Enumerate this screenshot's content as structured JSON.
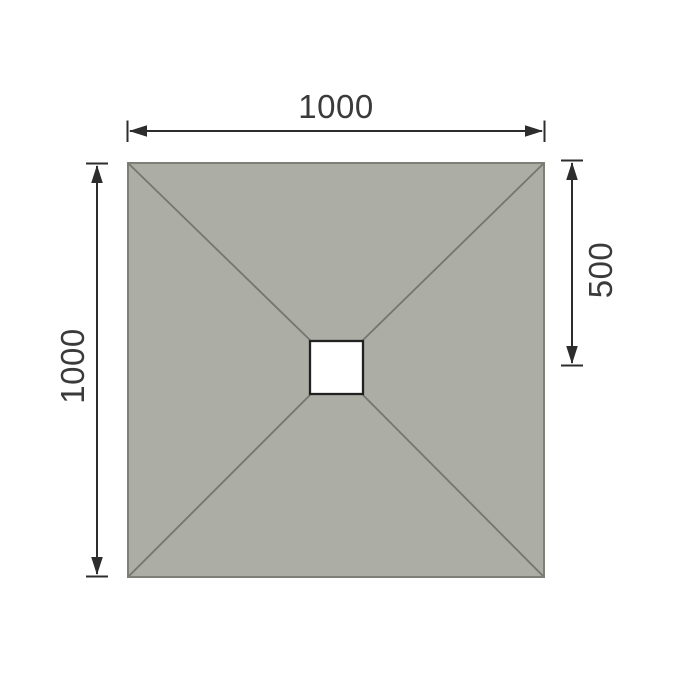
{
  "canvas": {
    "background": "#FFFFFF"
  },
  "diagram": {
    "tray": {
      "fill": "#ACADA5",
      "stroke": "#7E7F77"
    },
    "slope_lines": {
      "stroke": "#75766F"
    },
    "drain": {
      "fill": "#FFFFFF",
      "stroke": "#222222"
    },
    "dimensions": {
      "color": "#2D2D2D",
      "text_color": "#3A3A3A",
      "top_width": {
        "label": "1000"
      },
      "left_height": {
        "label": "1000"
      },
      "right_drain_offset": {
        "label": "500"
      }
    }
  }
}
